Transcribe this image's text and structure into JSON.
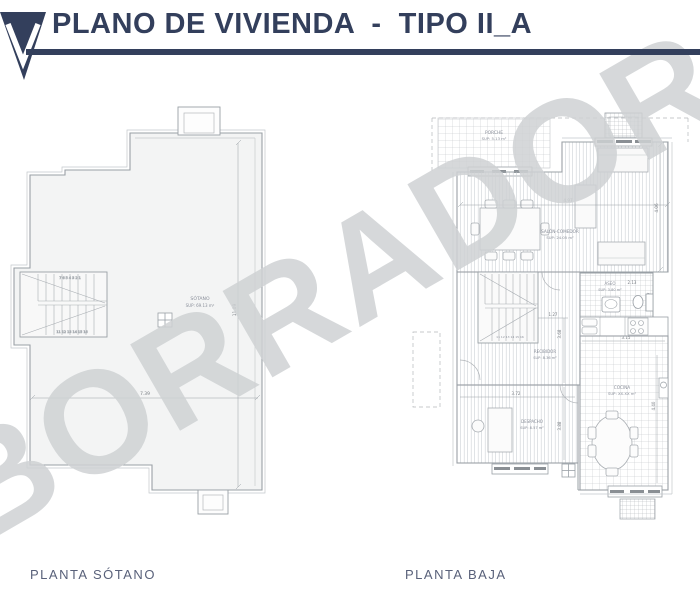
{
  "header": {
    "title": "PLANO DE VIVIENDA  -  TIPO II_A",
    "accent_color": "#333f5c"
  },
  "watermark": {
    "text": "BORRADOR",
    "color": "#cfd2d4"
  },
  "plans": {
    "sotano": {
      "caption": "PLANTA SÓTANO",
      "room": {
        "name": "SÓTANO",
        "sup": "SUP: 69.13 m²"
      },
      "dims": {
        "w": "7.39",
        "h": "11.09"
      },
      "stairs": {
        "top_row": "7  6  5  4  3  2  1",
        "bottom_row": "11 12 13 14 15 16"
      }
    },
    "baja": {
      "caption": "PLANTA BAJA",
      "rooms": {
        "porche": {
          "name": "PORCHE",
          "sup": "SUP: 5.13 m²"
        },
        "salon": {
          "name": "SALÓN-COMEDOR",
          "sup": "SUP: 24.05 m²"
        },
        "aseo": {
          "name": "ASEO",
          "sup": "SUP: 3.80 m²"
        },
        "recibidor": {
          "name": "RECIBIDOR",
          "sup": "SUP: 8.36 m²"
        },
        "cocina": {
          "name": "COCINA",
          "sup": "SUP: XX.XX m²"
        },
        "despacho": {
          "name": "DESPACHO",
          "sup": "SUP: 8.57 m²"
        }
      },
      "dims": {
        "salon_w": "4.97",
        "salon_h": "4.06",
        "aseo_w": "2.13",
        "aseo_h": "1.37",
        "recibidor_w": "1.27",
        "recibidor_h": "3.68",
        "cocina_w": "3.15",
        "cocina_h": "4.40",
        "despacho_w": "3.72",
        "despacho_h": "3.88"
      },
      "stairs": {
        "bottom_row": "11 12 13 14 15 16"
      }
    }
  }
}
